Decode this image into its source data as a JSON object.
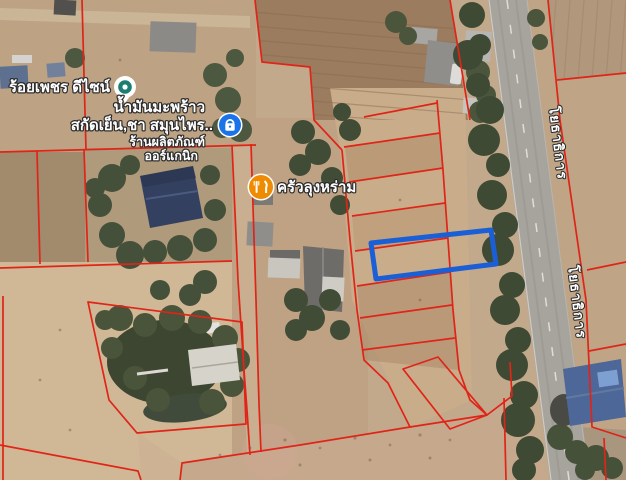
{
  "map": {
    "view": "satellite-imagery",
    "pois": [
      {
        "id": "roi-phet-design",
        "label": "ร้อยเพชร ดีไซน์",
        "marker": "generic-place-pin",
        "marker_color": "#1b7e71"
      },
      {
        "id": "coconut-oil-herb-shop",
        "label_line1": "น้ำมันมะพร้าว",
        "label_line2": "สกัดเย็น,ชา สมุนไพร..",
        "label_line3": "ร้านผลิตภัณฑ์",
        "label_line4": "ออร์แกนิก",
        "marker": "lock-badge",
        "marker_color": "#1a73e8"
      },
      {
        "id": "khrua-lung-ram",
        "label": "ครัวลุงหร่าม",
        "marker": "restaurant-pin",
        "marker_color": "#ef8b00"
      }
    ],
    "road_label": "โยธาธิการ",
    "overlays": {
      "boundary_color": "#e02418",
      "highlight_color": "#1a5fd6",
      "highlight_meaning": "selected land plot outline"
    }
  }
}
